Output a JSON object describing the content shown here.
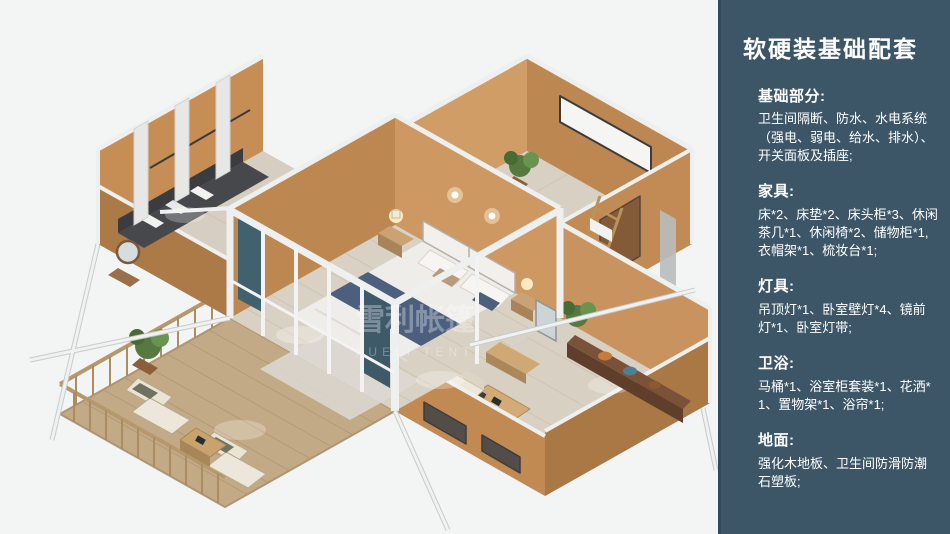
{
  "panel": {
    "title": "软硬装基础配套",
    "sections": [
      {
        "heading": "基础部分:",
        "body": "卫生间隔断、防水、水电系统（强电、弱电、给水、排水）、开关面板及插座;"
      },
      {
        "heading": "家具:",
        "body": "床*2、床垫*2、床头柜*3、休闲茶几*1、休闲椅*2、储物柜*1, 衣帽架*1、梳妆台*1;"
      },
      {
        "heading": "灯具:",
        "body": "吊顶灯*1、卧室壁灯*4、镜前灯*1、卧室灯带;"
      },
      {
        "heading": "卫浴:",
        "body": "马桶*1、浴室柜套装*1、花洒*1、置物架*1、浴帘*1;"
      },
      {
        "heading": "地面:",
        "body": "强化木地板、卫生间防滑防潮石塑板;"
      }
    ]
  },
  "illustration": {
    "watermark": {
      "cn": "雪利帐篷",
      "en": "XUELI TENT"
    },
    "colors": {
      "panel_bg": "#3c5668",
      "wall_tan": "#c9935f",
      "frame_white": "#eef0ef",
      "bedding_accent": "#4d5f7e",
      "floor_wood": "#d8d0c2",
      "deck_wood": "#c3aa86"
    }
  }
}
